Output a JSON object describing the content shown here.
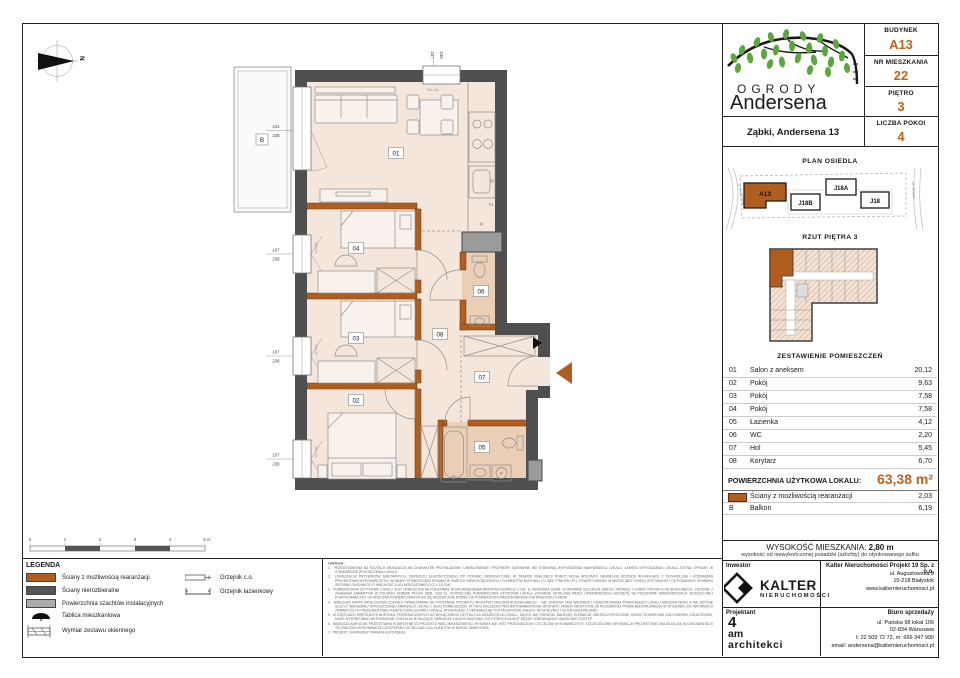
{
  "colors": {
    "accent": "#c2611e",
    "wall_orange": "#b05e1f",
    "wall_dark": "#4f4f4f",
    "shaft_gray": "#9b9b9b",
    "floor": "#f4e6db",
    "floor_wet": "#eacfb6",
    "leaf_green": "#5aa73c"
  },
  "header": {
    "budynek_label": "BUDYNEK",
    "budynek_value": "A13",
    "mieszkanie_label": "NR MIESZKANIA",
    "mieszkanie_value": "22",
    "pietro_label": "PIĘTRO",
    "pietro_value": "3",
    "pokoje_label": "LICZBA POKOI",
    "pokoje_value": "4"
  },
  "brand": {
    "name_top": "OGRODY",
    "name_bottom": "Andersena",
    "address": "Ząbki, Andersena 13"
  },
  "site_plan": {
    "title": "PLAN OSIEDLA",
    "a13": "A13",
    "j18b": "J18B",
    "j18a": "J18A",
    "j18": "J18",
    "street_left": "ul. Andersena",
    "street_right": "ul. Skrajna"
  },
  "floor_thumb": {
    "title": "RZUT PIĘTRA 3"
  },
  "rooms": {
    "title": "ZESTAWIENIE POMIESZCZEŃ",
    "rows": [
      {
        "no": "01",
        "name": "Salon z aneksem",
        "area": "20,12"
      },
      {
        "no": "02",
        "name": "Pokój",
        "area": "9,63"
      },
      {
        "no": "03",
        "name": "Pokój",
        "area": "7,58"
      },
      {
        "no": "04",
        "name": "Pokój",
        "area": "7,58"
      },
      {
        "no": "05",
        "name": "Łazienka",
        "area": "4,12"
      },
      {
        "no": "06",
        "name": "WC",
        "area": "2,20"
      },
      {
        "no": "07",
        "name": "Hol",
        "area": "5,45"
      },
      {
        "no": "08",
        "name": "Korytarz",
        "area": "6,70"
      }
    ],
    "total_label": "POWIERZCHNIA UŻYTKOWA LOKALU:",
    "total_value": "63,38 m²",
    "extra_walls": {
      "name": "Ściany z możliwością rearanżacji",
      "area": "2,03"
    },
    "extra_balkon": {
      "no": "B",
      "name": "Balkon",
      "area": "6,19"
    }
  },
  "height_info": {
    "label": "WYSOKOŚĆ MIESZKANIA:",
    "value": "2,80 m",
    "note": "wysokość od niewykończonej posadzki (szlichty) do otynkowanego sufitu"
  },
  "footer": {
    "inwestor_label": "Inwestor",
    "projektant_label": "Projektant",
    "kalter_name": "KALTER",
    "kalter_sub": "NIERUCHOMOŚCI",
    "company": "Kalter Nieruchomości Projekt 19 Sp. z o.o.",
    "company_addr1": "ul. Augustowska 8",
    "company_addr2": "15-218 Białystok",
    "company_www": "www.kalternieruchomosci.pl",
    "biuro_label": "Biuro sprzedaży",
    "biuro_addr1": "ul. Pańska 98 lokal 106",
    "biuro_addr2": "02-834 Warszawa",
    "biuro_phone": "t: 22 509 72 72, m: 666 347 990",
    "biuro_email": "email: andersena@kalternieruchomosci.pl",
    "designer_1": "4",
    "designer_2": "am",
    "designer_3": "architekci"
  },
  "legend": {
    "title": "LEGENDA",
    "item_rearr": "Ściany z możliwością rearanżacji",
    "item_fixed": "Ściany nierozbieralne",
    "item_shaft": "Powierzchnia szachtów instalacyjnych",
    "item_board": "Tablica mieszkaniowa",
    "item_window": "Wymiar zestawu okiennego",
    "item_radiator": "Grzejnik c.o.",
    "item_towel": "Grzejnik łazienkowy"
  },
  "uwaga": {
    "title": "UWAGA:",
    "notes": [
      "PRZEDSTAWIONA NA RZUTACH ARANŻACJA MA CHARAKTER PRZYKŁADOWY. UMEBLOWANIE I PRZYBORY SANITARNE NIE STANOWIĄ WYPOSAŻENIA NABYWANEGO LOKALU. ZAKRES WYPOSAŻENIA LOKALU ZOSTAŁ OPISANY W STANDARDZIE WYKOŃCZENIA LOKALU.",
      "LOKALIZACJE PRZYBORÓW SANITARNYCH, OSPRZĘTU ELEKTRYCZNEGO ITP. PODANO ORIENTACYJNIE. W TRAKCIE REALIZACJI ROBÓT MOGĄ WYSTĄPIĆ NIEWIELKIE RÓŻNICE WYNIKAJĄCE Z TECHNOLOGII I ROZWIĄZAŃ PROJEKTOWO-WYKONAWCZYCH. WYMIARY POMIESZCZEŃ PODANO W ŚWIETLE NIEWYKOŃCZONYCH ELEMENTÓW BUDYNKU (TJ. BEZ TYNKÓW ITP.). OTWÓR OKIENNY W MURZE (BEZ TYNKU) JEST WIĘKSZY OD PODANEGO WYMIARU ZESTAWU OKIENNEGO O WIELKOŚĆ LUZU MONTAŻOWEGO (2 X 1,5 CM).",
      "POWIERZCHNIA UŻYTKOWA LOKALU JEST OKREŚLONA NA PODSTAWIE ROZPORZĄDZENIA MINISTRA ROZWOJU Z DN. 11 WRZEŚNIA 2020R. W SPRAWIE SZCZEGÓŁOWEGO ZAKRESU I FORMY PROJEKTU BUDOWLANEGO, ZGODNIE Z ZASADAMI ZAWARTYMI W POLSKIEJ NORMIE PN-ISO 9836: 2015-12. OSTATECZNA POWIERZCHNIA UŻYTKOWA LOKALU ZOSTANIE USTALONA PRZEZ UPRAWNIONEGO GEODETĘ NA PODSTAWIE INWENTARYZACJI GEODEZYJNEJ POWYKONAWCZEJ. OSTATECZNA POWIERZCHNIA MOŻE SIĘ NIEZNACZNIE RÓŻNIĆ OD POWIERZCHNI PRZEDSTAWIONEJ NA NINIEJSZEJ KARCIE.",
      "NINIEJSZA KARTA KATALOGOWA ZOSTAŁA OPRACOWANA NA PODSTAWIE PROJEKTU ARCHITEKTONICZNO-BUDOWLANEGO – NIE STANOWI ONA WIERNEGO ODWZOROWANIA POWSTAŁEGO LOKALU MIESZKALNEGO A MA JEDYNIE SŁUŻYĆ WSKAZANIU UPROSZCZONEJ ARANŻACJI LOKALU I JEGO POMIESZCZEŃ. W TOKU DALSZEGO PROJEKTOWANIA MOGĄ WYSTĄPIĆ ZMIANY NIEISTOTNE (W ROZUMIENIU PRAWA BUDOWLANEGO) W STOSUNKU DO INFORMACJI ZAWARTYCH W PRZEDMIOTOWEJ KARCIE KATALOGOWEJ LOKALU, WYNIKAJĄCE Z OBOWIĄZUJĄCYCH PRZEPISÓW, WIEDZY TECHNICZNEJ I SZTUKI BUDOWLANEJ.",
      "W CZĘŚCIACH WSPÓLNYCH BUDYNKU, PRZEZNACZONYCH DO WYŁĄCZNEGO UŻYTKU DLA WŁAŚCICIELA LOKALU, TAKICH JAK OGRÓDKI, BALKONY, ELEWACJE, MIEJSCA POSTOJOWE, BOKSY ROWEROWE LUB KOMÓRKI LOKATORSKIE, MOŻE WYSTĘPOWAĆ WYPOSAŻENIE I INSTALACJE SŁUŻĄCE OBSŁUDZE CAŁEGO BUDYNKU, DO KTÓRYCH KLIENT BĘDZIE ZOBOWIĄZANY UMOŻLIWIĆ DOSTĘP.",
      "NINIEJSZA KARTA NIE PRZEDSTAWIA KOMPLETNEGO PROJEKTU WIELOBRANŻOWEGO. RYSUNEK NIE JEST PRZEZNACZONY DO CELÓW WYKONAWCZYCH. SZCZEGÓŁOWE INFORMACJE PROJEKTOWE ZNAJDUJĄ SIĘ W DOKUMENTACJI TECHNICZNO-WYKONAWCZEJ DOSTĘPNEJ DO WGLĄDU DLA KLIENTÓW W BIURZE INWESTORA.",
      "PROJEKT CHRONIONY PRAWEM AUTORSKIM."
    ]
  },
  "plan": {
    "labels": {
      "r01": "01",
      "r02": "02",
      "r03": "03",
      "r04": "04",
      "r05": "05",
      "r06": "06",
      "r07": "07",
      "r08": "08",
      "balkon": "B",
      "north": "N",
      "dishwasher": "Z",
      "washer": "P"
    },
    "symbols": {
      "fridge": "✳"
    },
    "dims": {
      "w241": "241",
      "h238": "238",
      "w107": "107"
    },
    "window_note": "5x91,5b",
    "scale": {
      "s0": "0",
      "s1": "1",
      "s2": "2",
      "s3": "3",
      "s4": "4",
      "s5": "5 m"
    }
  }
}
